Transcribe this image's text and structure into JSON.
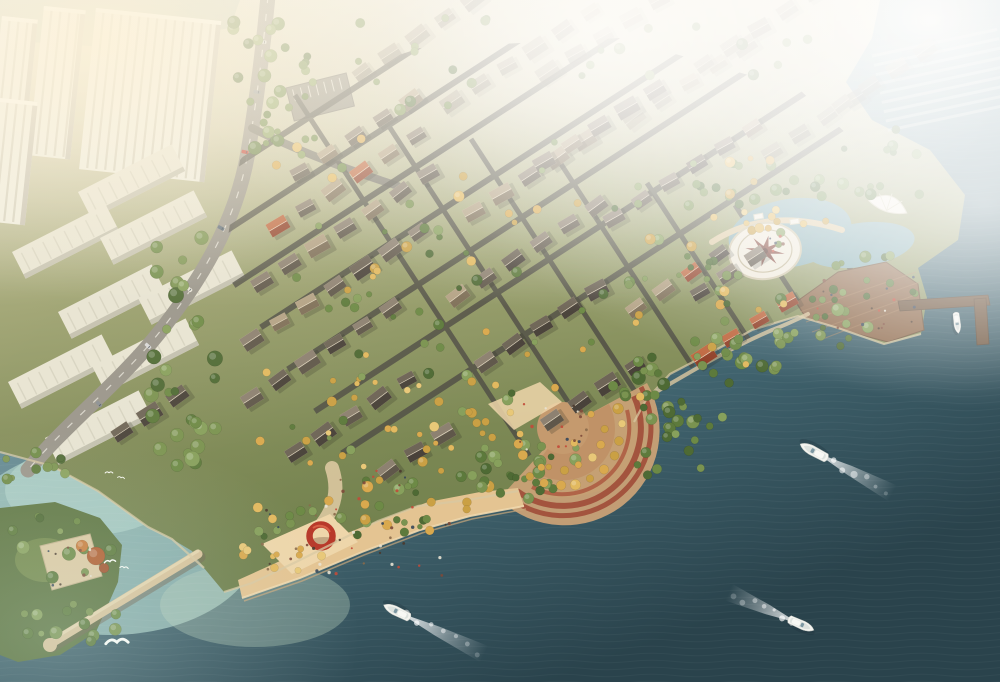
{
  "scene": {
    "title": "aerial-rendering-waterfront-villa-community",
    "description": "birds-eye architectural rendering: villa district on a river promontory with beach, plazas, piers, yachts and mist"
  },
  "palette": {
    "water_hint": "#aebfae",
    "tower": "#edecdf",
    "tower_stripe": "#cbc8b6",
    "tower_shadow": "#b5b2a2",
    "slab": "#e7e4d3",
    "slab_shadow": "#b9b6a6",
    "road_main": "#98948a",
    "road_dash": "#f3f1e8",
    "road_internal": "#514f46",
    "spur": "#7d7a6e",
    "walk": "#dcc8a0",
    "seawall": "#d8c8a2",
    "sand": "#e4c492",
    "sand_light": "#eed6aa",
    "sand_step": "#f0d8ae",
    "sand_step_dark": "#c9a87c",
    "terracotta": "#a3543e",
    "terracotta_light": "#b06448",
    "amphi_fill": "#c9a176",
    "amphi_inner": "#c09267",
    "amphi_core": "#c59a6e",
    "deck": "#8f6a4c",
    "deck_line": "#a9835f",
    "deck_edge": "#6e5138",
    "pier": "#6e553e",
    "pier_stroke": "#5a4532",
    "lagoon": "#85acb2",
    "compass_base": "#efe9da",
    "compass_ring": "#bfb392",
    "compass_star": "#84463a",
    "compass_edge": "#cfc5a8",
    "shell": "#f3efe3",
    "shell_line": "#d9d2ba",
    "island": "#5c7440",
    "island_meadow": "#7c9150",
    "pave": "#dcc9a2",
    "pave_edge": "#c4b28c",
    "breakwater": "#d8c29a",
    "breakwater_hi": "#e9d8b2",
    "breakwater_sh": "#6f6350",
    "sculpture": "#b8392a",
    "sculpture_hi": "#e06a4e",
    "hull": "#f4f4ef",
    "hull_stroke": "#c9ccc6",
    "boat_deck": "#dde2de",
    "canopy": "#f8f8f4",
    "windshield": "#6b8a98",
    "boat_shadow": "#1e333a",
    "foam": "#ffffff",
    "gull": "#fdfdf8",
    "parking": "#8f8b7d",
    "parking_tick": "#d8d5c8"
  },
  "gradients": {
    "gradWater": [
      [
        "0",
        "#b9cfd1",
        "1"
      ],
      [
        "0.42",
        "#6f98a2",
        "1"
      ],
      [
        "0.72",
        "#41646f",
        "1"
      ],
      [
        "1",
        "#2a434c",
        "1"
      ]
    ],
    "gradLand": [
      [
        "0",
        "#e7e2cf",
        "1"
      ],
      [
        "0.25",
        "#cfcbab",
        "1"
      ],
      [
        "0.5",
        "#9aa06e",
        "1"
      ],
      [
        "0.78",
        "#7c8854",
        "1"
      ],
      [
        "1",
        "#6f7f4c",
        "1"
      ]
    ],
    "gradWake": [
      [
        "0",
        "#ffffff",
        "0.9"
      ],
      [
        "0.55",
        "#ffffff",
        "0.35"
      ],
      [
        "1",
        "#ffffff",
        "0"
      ]
    ],
    "fogBand": [
      [
        "0",
        "#ffffff",
        "0.5"
      ],
      [
        "0.2",
        "#ffffff",
        "0.28"
      ],
      [
        "0.45",
        "#ffffff",
        "0"
      ]
    ],
    "fogTR": [
      [
        "0",
        "#ffffff",
        "0.96"
      ],
      [
        "0.45",
        "#ffffff",
        "0.55"
      ],
      [
        "1",
        "#ffffff",
        "0"
      ]
    ],
    "fogTC": [
      [
        "0",
        "#ffffff",
        "0.8"
      ],
      [
        "0.5",
        "#ffffff",
        "0.34"
      ],
      [
        "1",
        "#ffffff",
        "0"
      ]
    ],
    "fogTL": [
      [
        "0",
        "#fdf3da",
        "0.8"
      ],
      [
        "0.5",
        "#fdf3da",
        "0.32"
      ],
      [
        "1",
        "#fdf3da",
        "0"
      ]
    ],
    "fogR": [
      [
        "0",
        "#ffffff",
        "0.55"
      ],
      [
        "1",
        "#ffffff",
        "0"
      ]
    ],
    "glowBL": [
      [
        "0",
        "#d8ece4",
        "0.28"
      ],
      [
        "1",
        "#d8ece4",
        "0"
      ]
    ],
    "warmTint": [
      [
        "0",
        "#ffefd2",
        "0.2"
      ],
      [
        "1",
        "#ffefd2",
        "0"
      ]
    ]
  },
  "city": {
    "towers": [
      {
        "x": 2,
        "y": 16,
        "rot": 6,
        "w": 36,
        "h": 128
      },
      {
        "x": 44,
        "y": 6,
        "rot": 6,
        "w": 42,
        "h": 150
      },
      {
        "x": 96,
        "y": 8,
        "rot": 6,
        "w": 126,
        "h": 162
      },
      {
        "x": 0,
        "y": 98,
        "rot": 6,
        "w": 38,
        "h": 124
      }
    ],
    "slabs": [
      {
        "x": 78,
        "y": 192
      },
      {
        "x": 12,
        "y": 252
      },
      {
        "x": 100,
        "y": 238
      },
      {
        "x": 58,
        "y": 312
      },
      {
        "x": 138,
        "y": 298
      },
      {
        "x": 8,
        "y": 382
      },
      {
        "x": 92,
        "y": 366
      },
      {
        "x": 45,
        "y": 438
      }
    ],
    "slab_size": {
      "w": 105,
      "h": 30,
      "rot": -27
    },
    "marina_haze": {
      "x": 872,
      "y": 56,
      "n": 9,
      "len": 128,
      "dy": 9.5,
      "rot": -12,
      "color": "#c8d2cc"
    },
    "parking": {
      "x": 286,
      "y": 88,
      "rot": -14,
      "w": 62,
      "h": 34,
      "ticks": 7
    },
    "cars": [
      {
        "x": 263,
        "y": 42,
        "rot": 94
      },
      {
        "x": 257,
        "y": 92,
        "rot": 97
      },
      {
        "x": 245,
        "y": 152,
        "rot": 103
      },
      {
        "x": 221,
        "y": 228,
        "rot": 118
      },
      {
        "x": 189,
        "y": 289,
        "rot": 128
      },
      {
        "x": 148,
        "y": 346,
        "rot": 133
      },
      {
        "x": 99,
        "y": 404,
        "rot": 138
      }
    ],
    "car_colors": [
      "#d9d9d9",
      "#8a8f94",
      "#c23b2e",
      "#5a6a78",
      "#e8e5da"
    ]
  },
  "streets": {
    "diag": {
      "x0": 205,
      "y0": 185,
      "stepx": 27,
      "stepy": 42,
      "n": 7,
      "len": 700,
      "dirx": 0.839,
      "diry": -0.545,
      "width": 6
    },
    "cross": {
      "x0": 295,
      "y0": 95,
      "stepx": 88,
      "stepy": 22,
      "n": 7,
      "len": 430,
      "dirx": 0.545,
      "diry": 0.839,
      "width": 5
    }
  },
  "villas": {
    "params": {
      "angle": -33,
      "dx": 27.7,
      "dy": -18
    },
    "walls": [
      "#ecdcba",
      "#e4d2ac",
      "#f0e2c4"
    ],
    "roofs": {
      "grey": [
        "#8d8171",
        "#5f574a"
      ],
      "dark": [
        "#6e6557",
        "#49423a"
      ],
      "red": [
        "#c06a43",
        "#92422a"
      ],
      "tan": [
        "#b3a285",
        "#7e6f58"
      ]
    },
    "rows_main": [
      [
        300,
        172,
        5,
        "grey"
      ],
      [
        278,
        226,
        6,
        "mixed"
      ],
      [
        262,
        282,
        7,
        "grey"
      ],
      [
        252,
        340,
        7,
        "mixed"
      ],
      [
        252,
        398,
        6,
        "grey"
      ],
      [
        296,
        452,
        5,
        "dark"
      ],
      [
        388,
        470,
        3,
        "dark"
      ],
      [
        474,
        212,
        5,
        "grey"
      ],
      [
        458,
        296,
        6,
        "mixed"
      ],
      [
        486,
        362,
        5,
        "mixed"
      ],
      [
        552,
        420,
        4,
        "dark"
      ],
      [
        544,
        162,
        5,
        "grey"
      ],
      [
        614,
        218,
        6,
        "grey"
      ],
      [
        636,
        308,
        4,
        "mixed"
      ],
      [
        704,
        356,
        4,
        "red"
      ],
      [
        700,
        292,
        3,
        "grey"
      ],
      [
        122,
        432,
        3,
        "dark"
      ]
    ],
    "rows_upper": [
      [
        362,
        72,
        6
      ],
      [
        452,
        102,
        6
      ],
      [
        548,
        72,
        5
      ],
      [
        634,
        118,
        5
      ],
      [
        704,
        64,
        5
      ],
      [
        772,
        152,
        4
      ],
      [
        842,
        104,
        4
      ]
    ]
  },
  "trees": {
    "palettes": {
      "g": [
        "#5d7a3c",
        "#6d8a46",
        "#4e6a34",
        "#7a9350",
        "#87a05c"
      ],
      "G": [
        "#d9a94e",
        "#e2b95f",
        "#caa044",
        "#e8c878"
      ],
      "m": [
        "#5d7a3c",
        "#6d8a46",
        "#d9a94e",
        "#7a9350",
        "#e2b95f",
        "#4e6a34",
        "#caa044",
        "#87a05c"
      ]
    },
    "rect_bands": [
      [
        150,
        228,
        66,
        240,
        32,
        "g",
        4,
        8
      ],
      [
        230,
        0,
        54,
        150,
        20,
        "g",
        3,
        7
      ],
      [
        8,
        515,
        108,
        128,
        24,
        "g",
        3,
        7
      ],
      [
        236,
        546,
        86,
        34,
        10,
        "G",
        2.5,
        4.5
      ],
      [
        352,
        516,
        84,
        30,
        8,
        "m",
        2.5,
        5
      ],
      [
        252,
        498,
        118,
        42,
        14,
        "m",
        3,
        6
      ],
      [
        362,
        468,
        128,
        46,
        16,
        "m",
        3,
        6
      ],
      [
        474,
        442,
        116,
        44,
        14,
        "g",
        3,
        6.5
      ],
      [
        618,
        368,
        112,
        56,
        20,
        "g",
        3.5,
        7
      ],
      [
        688,
        328,
        112,
        52,
        18,
        "g",
        3.5,
        7
      ],
      [
        778,
        293,
        92,
        46,
        14,
        "g",
        3,
        6.5
      ],
      [
        832,
        254,
        84,
        46,
        12,
        "g",
        3,
        6
      ],
      [
        688,
        162,
        152,
        50,
        18,
        "g",
        3,
        6
      ],
      [
        842,
        128,
        84,
        74,
        12,
        "g",
        3,
        6
      ],
      [
        248,
        138,
        224,
        324,
        46,
        "m",
        2.5,
        5.5
      ],
      [
        458,
        138,
        384,
        262,
        62,
        "m",
        2.5,
        5.5
      ],
      [
        298,
        378,
        304,
        92,
        28,
        "G",
        2.5,
        5
      ],
      [
        298,
        18,
        524,
        94,
        26,
        "g",
        3,
        6
      ],
      [
        276,
        40,
        42,
        122,
        10,
        "g",
        3,
        5
      ],
      [
        684,
        252,
        58,
        30,
        8,
        "g",
        3,
        5
      ],
      [
        0,
        440,
        72,
        42,
        10,
        "g",
        3,
        6
      ],
      [
        478,
        458,
        92,
        44,
        12,
        "g",
        3,
        6
      ],
      [
        636,
        426,
        84,
        52,
        12,
        "g",
        3,
        6.5
      ],
      [
        712,
        208,
        120,
        26,
        9,
        "G",
        3,
        5
      ],
      [
        466,
        412,
        56,
        34,
        6,
        "G",
        3,
        5
      ]
    ],
    "arc_bands": [
      [
        563,
        428,
        58,
        -20,
        125,
        10,
        "G",
        3.5,
        5.5
      ],
      [
        563,
        428,
        41,
        0,
        112,
        6,
        "G",
        3,
        4.5
      ]
    ],
    "extra": [
      [
        96,
        556,
        9,
        "#b05c2e"
      ],
      [
        82,
        546,
        6,
        "#c97b3a"
      ],
      [
        104,
        568,
        5,
        "#a0522d"
      ]
    ]
  },
  "people": {
    "colors": [
      "#4a3a2e",
      "#7d4a3a",
      "#35465a",
      "#e8e2d2",
      "#8a6a4a",
      "#c24a38"
    ],
    "regions": [
      [
        262,
        505,
        190,
        72,
        36
      ],
      [
        816,
        272,
        100,
        58,
        12
      ],
      [
        46,
        542,
        54,
        44,
        9
      ],
      [
        518,
        398,
        72,
        52,
        9
      ],
      [
        744,
        232,
        42,
        22,
        5
      ],
      [
        292,
        470,
        120,
        40,
        12
      ],
      [
        540,
        408,
        46,
        40,
        8
      ],
      [
        878,
        300,
        40,
        30,
        6
      ]
    ]
  },
  "boats": [
    {
      "x": 815,
      "y": 452,
      "rot": 208,
      "s": 1.05,
      "wake": 88
    },
    {
      "x": 398,
      "y": 612,
      "rot": 206,
      "s": 1.0,
      "wake": 96
    },
    {
      "x": 800,
      "y": 624,
      "rot": 24,
      "s": 0.95,
      "wake": 78
    },
    {
      "x": 957,
      "y": 322,
      "rot": 83,
      "s": 0.72,
      "wake": 0
    }
  ],
  "gulls": [
    {
      "x": 110,
      "y": 562,
      "s": 0.8,
      "rot": -8
    },
    {
      "x": 124,
      "y": 568,
      "s": 0.6,
      "rot": 6
    },
    {
      "x": 117,
      "y": 643,
      "s": 1.6,
      "rot": -4
    },
    {
      "x": 109,
      "y": 473,
      "s": 0.55,
      "rot": 0
    },
    {
      "x": 121,
      "y": 478,
      "s": 0.5,
      "rot": 10
    }
  ],
  "compass": {
    "cx": 765,
    "cy": 251,
    "rx": 36,
    "ry": 28,
    "rot": -8,
    "star_outer": 20,
    "star_inner": 6.5,
    "squash": 0.78,
    "star_rot": 10
  }
}
